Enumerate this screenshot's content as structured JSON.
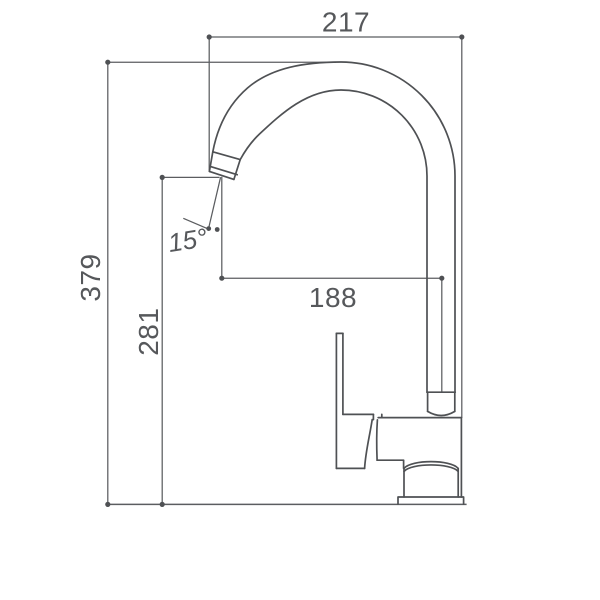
{
  "drawing": {
    "labels": {
      "top_width": "217",
      "total_height": "379",
      "spout_height": "281",
      "spout_reach": "188",
      "nozzle_angle": "15°"
    },
    "colors": {
      "outline": "#4f5154",
      "dimension_line": "#5b5d60",
      "text": "#56585b",
      "background": "#ffffff"
    }
  }
}
